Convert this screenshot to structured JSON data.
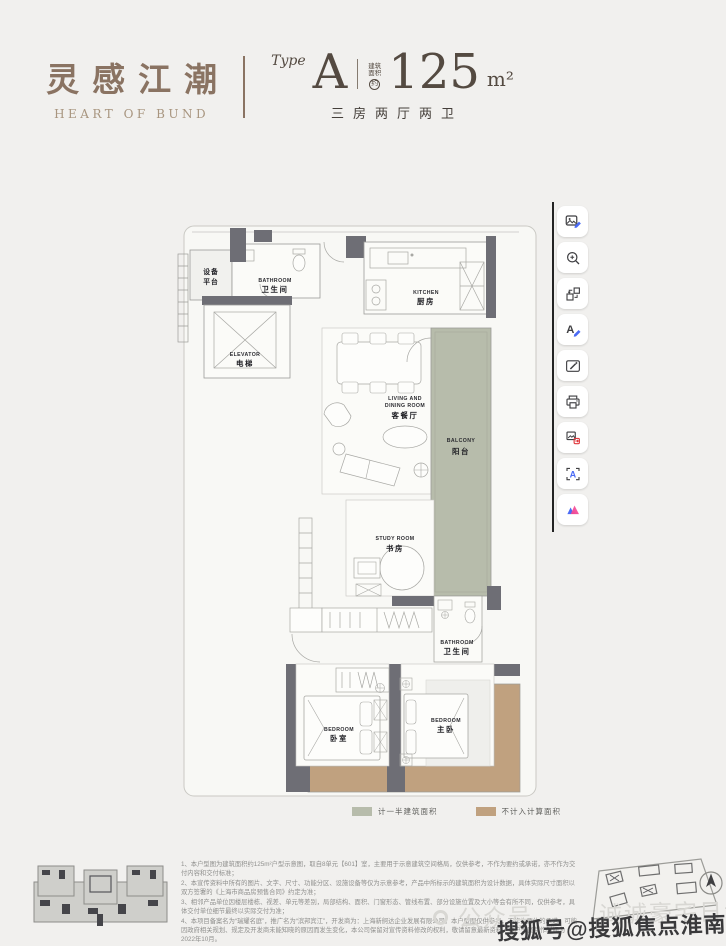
{
  "window": {
    "background": "#f1f0ee"
  },
  "header": {
    "brand_cn": "灵感江潮",
    "brand_en": "HEART OF BUND",
    "type_label": "Type",
    "type_value": "A",
    "area_prefix_1": "建筑",
    "area_prefix_2": "面积",
    "area_approx": "约",
    "area_value": "125",
    "area_unit": "m²",
    "layout_desc": "三房两厅两卫"
  },
  "floorplan": {
    "rooms": {
      "equipment": {
        "cn1": "设备",
        "cn2": "平台"
      },
      "bathroom_top": {
        "en": "BATHROOM",
        "cn": "卫生间"
      },
      "elevator": {
        "en": "ELEVATOR",
        "cn": "电梯"
      },
      "kitchen": {
        "en": "KITCHEN",
        "cn": "厨房"
      },
      "living": {
        "en1": "LIVING AND",
        "en2": "DINING ROOM",
        "cn": "客餐厅"
      },
      "balcony": {
        "en": "BALCONY",
        "cn": "阳台"
      },
      "study": {
        "en": "STUDY ROOM",
        "cn": "书房"
      },
      "bathroom_mid": {
        "en": "BATHROOM",
        "cn": "卫生间"
      },
      "bedroom": {
        "en": "BEDROOM",
        "cn": "卧室"
      },
      "master": {
        "en": "BEDROOM",
        "cn": "主卧"
      }
    },
    "colors": {
      "wall": "#6e6e75",
      "half_area": "#b7bcab",
      "excluded": "#c0a17f",
      "outline": "#9c9c98"
    }
  },
  "legend": {
    "half": {
      "label": "计一半建筑面积",
      "color": "#b7bcab"
    },
    "excluded": {
      "label": "不计入计算面积",
      "color": "#c0a17f"
    }
  },
  "toolbar": {
    "buttons": [
      {
        "name": "edit-image"
      },
      {
        "name": "zoom-in"
      },
      {
        "name": "swap-position"
      },
      {
        "name": "edit-text"
      },
      {
        "name": "smart-select"
      },
      {
        "name": "print"
      },
      {
        "name": "convert-image"
      },
      {
        "name": "ocr-text"
      },
      {
        "name": "app-logo"
      }
    ]
  },
  "notes": {
    "lines": [
      "1、本户型图为建筑面积约125m²户型示意图，取自8单元【601】室，主要用于示意建筑空间格局，仅供参考，不作为要约或承诺，亦不作为交付内容和交付标准；",
      "2、本宣传资料中所有的图片、文字、尺寸、功能分区、设施设备等仅为示意参考，产品中所标示的建筑面积为设计数据，具体实际尺寸面积以双方签署的《上海市商品房预售合同》约定为准；",
      "3、相邻产品单位因楼层楼栋、视差、单元等差别，局部结构、面积、门窗形态、管线布置、部分设施位置及大小等会有所不同，仅供参考，具体交付单位细节最终以实际交付为准；",
      "4、本项目备案名为“瑞耀名庭”，推广名为“滨邦宾江”，开发商为：上海新舸达企业发展有限公司。本户型图仅供参考，不作为要约的承诺，可能因政府相关规划、规定及开发商未能知晓的原因而发生变化，本公司保留对宣传资料修改的权利，敬请留意最新资料。本户型图制作时间为2022年10月。"
    ]
  },
  "watermarks": {
    "light_prefix": "公众号",
    "light_text": "诚诚豪宅日记",
    "dark": "搜狐号@搜狐焦点淮南站"
  }
}
